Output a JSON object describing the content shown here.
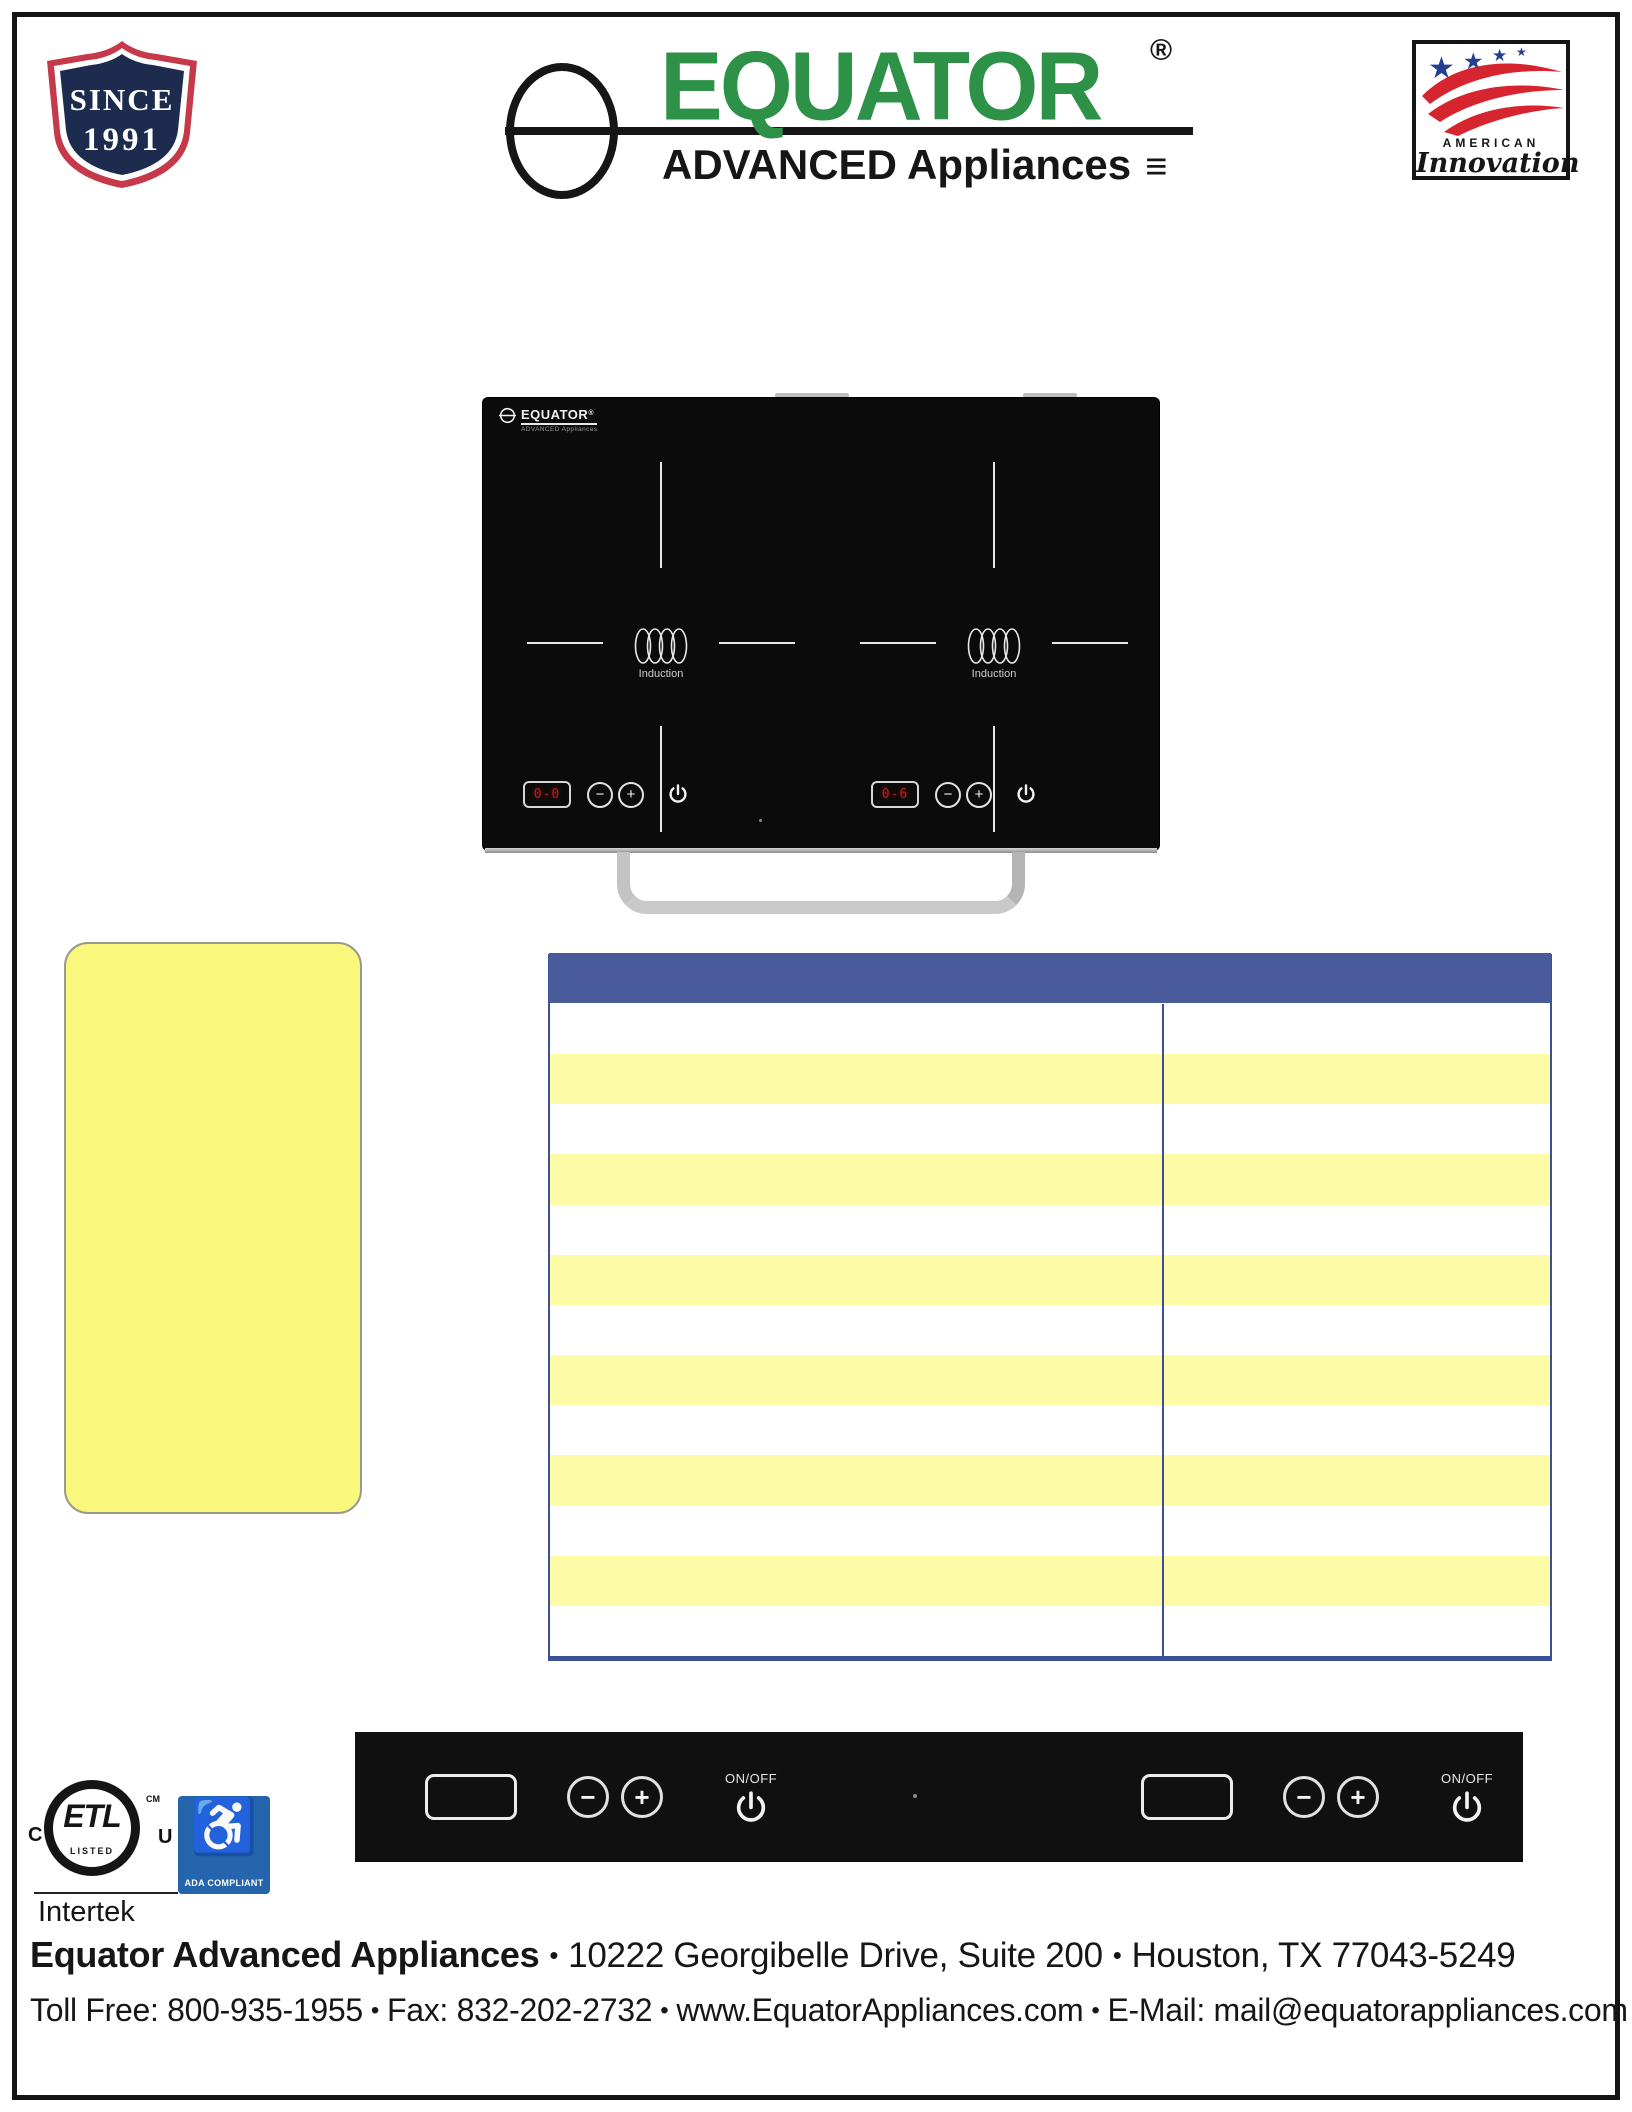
{
  "colors": {
    "brand_green": "#2E9148",
    "header_blue": "#4A5B9B",
    "table_border_blue": "#3C5096",
    "stripe_yellow": "#FDFBA6",
    "note_box_yellow": "#F9F77C",
    "led_red": "#C4161C",
    "ada_blue": "#2465AE",
    "badge_navy": "#1D2C4E",
    "badge_red": "#C5394A"
  },
  "header": {
    "since_badge": {
      "line1": "SINCE",
      "line2": "1991"
    },
    "logo": {
      "brand": "EQUATOR",
      "registered": "®",
      "tagline": "ADVANCED Appliances",
      "menu_glyph": "≡"
    },
    "american_innovation": {
      "line1": "AMERICAN",
      "line2": "Innovation",
      "star": "★"
    }
  },
  "cooktop_photo": {
    "mini_logo": {
      "brand": "EQUATOR",
      "registered": "®",
      "tagline": "ADVANCED Appliances"
    },
    "burner_label": "Induction",
    "left_display": "0-0",
    "right_display": "0-6",
    "minus_glyph": "−",
    "plus_glyph": "+"
  },
  "control_strip": {
    "on_off_label": "ON/OFF",
    "minus_glyph": "−",
    "plus_glyph": "+"
  },
  "spec_table": {
    "columns": 2,
    "body_rows": 13
  },
  "certifications": {
    "etl": {
      "mark": "ETL",
      "listed": "LISTED",
      "left_letter": "C",
      "right_letter": "U",
      "cm": "CM",
      "company": "Intertek"
    },
    "ada": {
      "symbol": "♿",
      "label": "ADA COMPLIANT"
    }
  },
  "footer": {
    "bullet": "•",
    "company": "Equator Advanced Appliances",
    "address": "10222 Georgibelle Drive, Suite 200",
    "city": "Houston, TX 77043-5249",
    "toll_free": "Toll Free: 800-935-1955",
    "fax": "Fax: 832-202-2732",
    "website": "www.EquatorAppliances.com",
    "email": "E-Mail: mail@equatorappliances.com"
  }
}
